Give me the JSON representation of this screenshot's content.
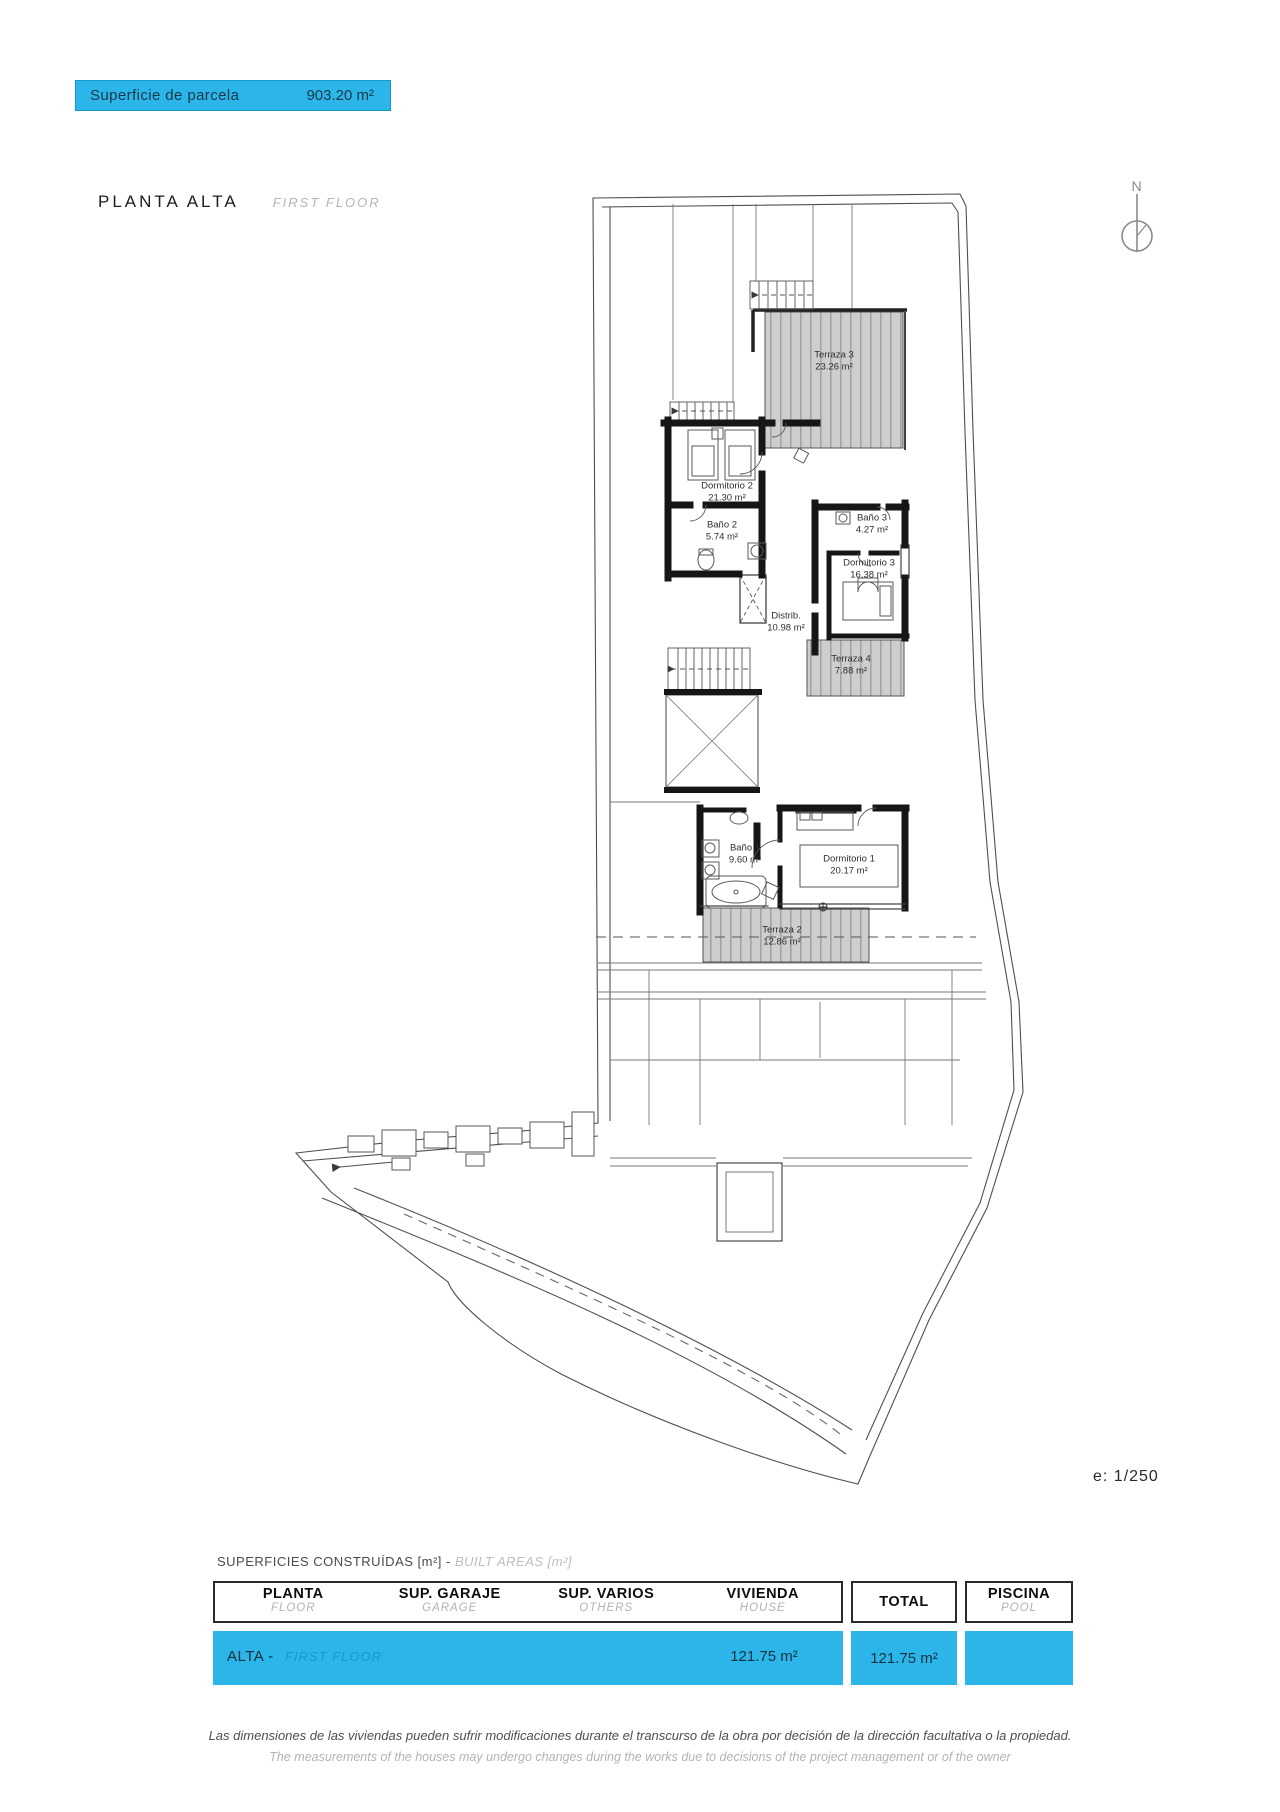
{
  "banner": {
    "label": "Superficie de parcela",
    "value": "903.20 m²"
  },
  "title": {
    "es": "PLANTA ALTA",
    "en": "FIRST FLOOR"
  },
  "compass": {
    "label": "N"
  },
  "scale": {
    "label": "e: 1/250"
  },
  "rooms": [
    {
      "name": "Terraza 3",
      "area": "23.26 m²"
    },
    {
      "name": "Dormitorio 2",
      "area": "21.30 m²"
    },
    {
      "name": "Baño 2",
      "area": "5.74 m²"
    },
    {
      "name": "Baño 3",
      "area": "4.27 m²"
    },
    {
      "name": "Dormitorio 3",
      "area": "16.38 m²"
    },
    {
      "name": "Distrib.",
      "area": "10.98 m²"
    },
    {
      "name": "Terraza 4",
      "area": "7.88 m²"
    },
    {
      "name": "Baño 1",
      "area": "9.60 m²"
    },
    {
      "name": "Dormitorio 1",
      "area": "20.17 m²"
    },
    {
      "name": "Terraza 2",
      "area": "12.86 m²"
    }
  ],
  "areas_table": {
    "caption_es": "SUPERFICIES CONSTRUÍDAS [m²] - ",
    "caption_en": "BUILT AREAS [m²]",
    "columns": [
      {
        "es": "PLANTA",
        "en": "FLOOR"
      },
      {
        "es": "SUP. GARAJE",
        "en": "GARAGE"
      },
      {
        "es": "SUP. VARIOS",
        "en": "OTHERS"
      },
      {
        "es": "VIVIENDA",
        "en": "HOUSE"
      },
      {
        "es": "TOTAL",
        "en": ""
      },
      {
        "es": "PISCINA",
        "en": "POOL"
      }
    ],
    "row": {
      "floor": "ALTA -",
      "floor_en": "FIRST FLOOR",
      "garage": "",
      "others": "",
      "house": "121.75 m²",
      "total": "121.75 m²",
      "pool": ""
    }
  },
  "disclaimer": {
    "es": "Las dimensiones de las viviendas pueden sufrir modificaciones durante el transcurso de la obra por decisión de la dirección facultativa o la propiedad.",
    "en": "The measurements of the houses may undergo changes during the works due to decisions of the project management or of the owner"
  },
  "colors": {
    "cyan": "#2CB5E9",
    "ghost_cyan": "#129BCE"
  }
}
